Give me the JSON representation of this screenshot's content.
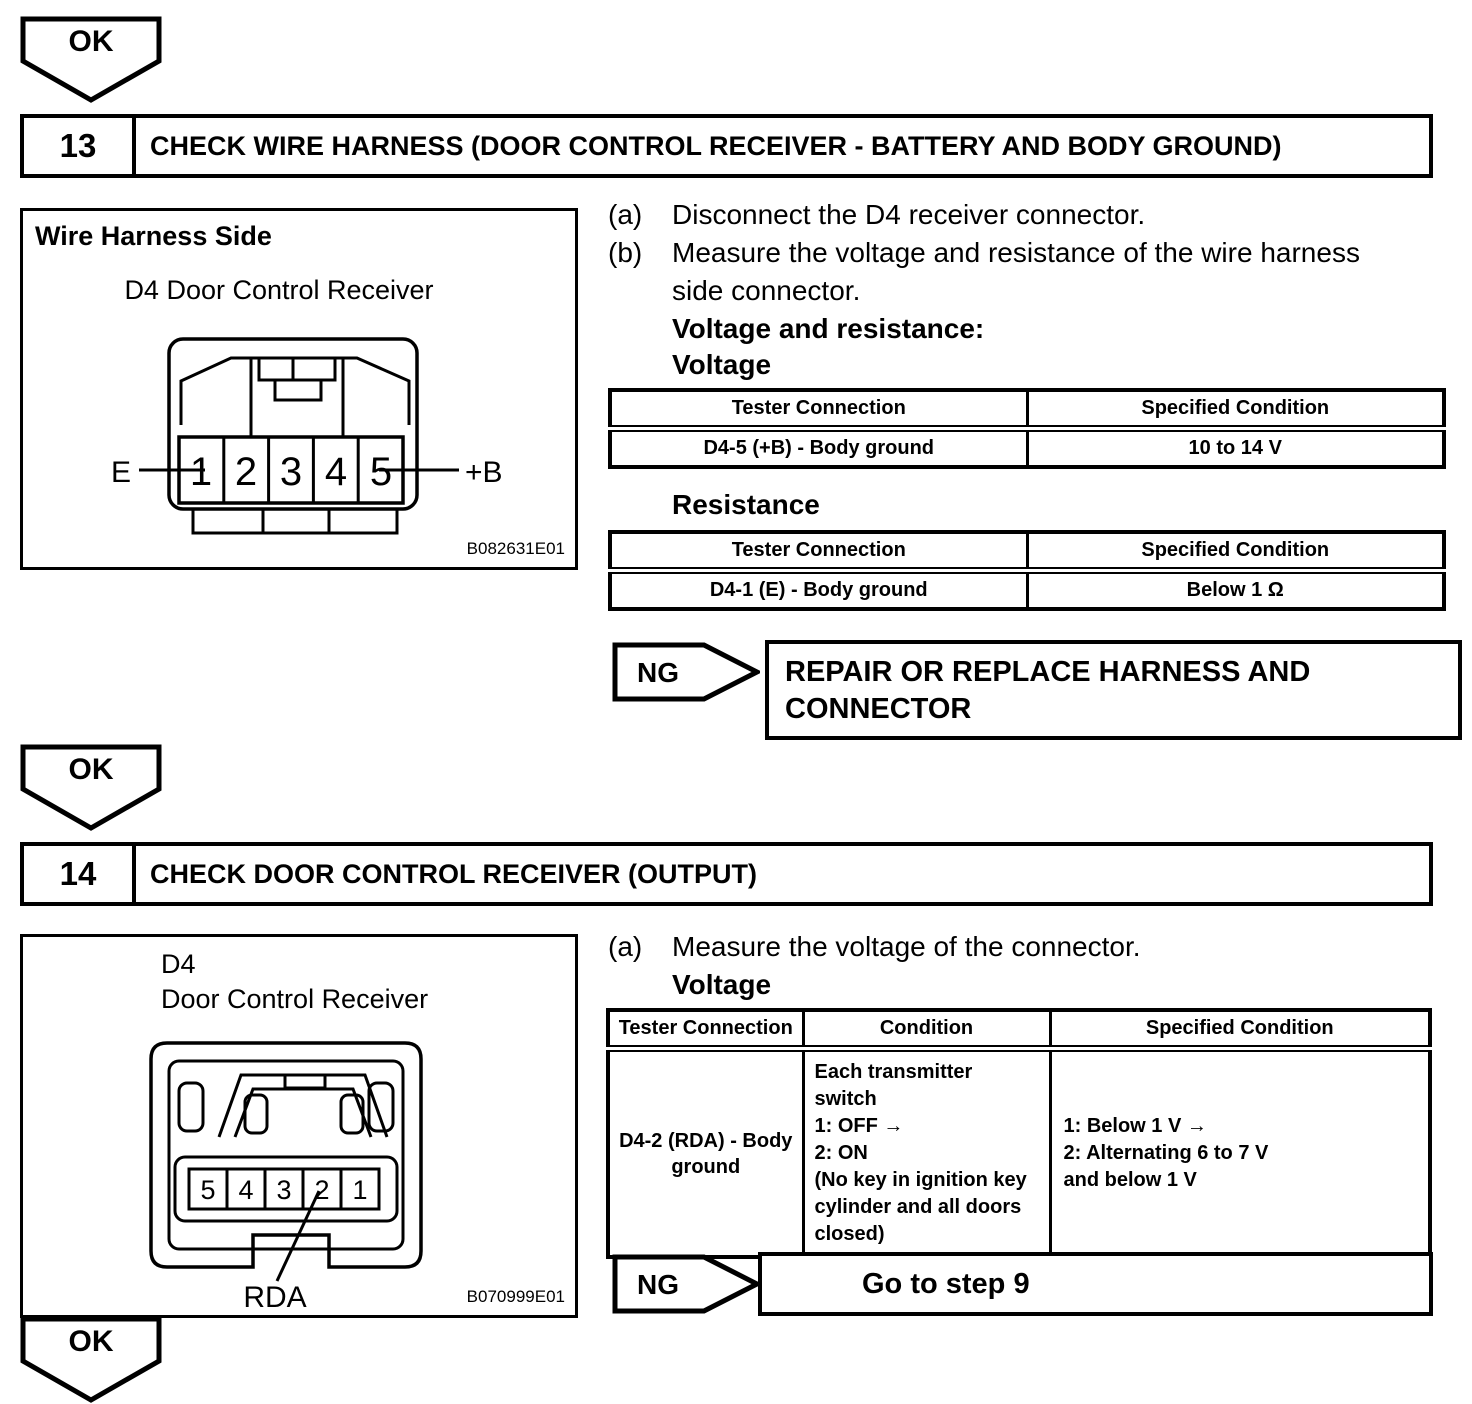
{
  "page": {
    "ok_label": "OK",
    "ng_label": "NG"
  },
  "step13": {
    "number": "13",
    "title": "CHECK WIRE HARNESS (DOOR CONTROL RECEIVER - BATTERY AND BODY GROUND)",
    "diagram": {
      "title": "Wire Harness Side",
      "subtitle": "D4 Door Control Receiver",
      "pins": [
        "1",
        "2",
        "3",
        "4",
        "5"
      ],
      "left_pin_label": "E",
      "right_pin_label": "+B",
      "code": "B082631E01"
    },
    "instructions": [
      {
        "index": "(a)",
        "text": "Disconnect the D4 receiver connector."
      },
      {
        "index": "(b)",
        "text": "Measure the voltage and resistance of the wire harness side connector."
      }
    ],
    "spec_label": "Voltage and resistance:",
    "voltage_heading": "Voltage",
    "voltage_table": {
      "headers": [
        "Tester Connection",
        "Specified Condition"
      ],
      "rows": [
        [
          "D4-5 (+B) - Body ground",
          "10 to 14 V"
        ]
      ]
    },
    "resistance_heading": "Resistance",
    "resistance_table": {
      "headers": [
        "Tester Connection",
        "Specified Condition"
      ],
      "rows": [
        [
          "D4-1 (E) - Body ground",
          "Below 1 Ω"
        ]
      ]
    },
    "ng_action": "REPAIR OR REPLACE HARNESS AND CONNECTOR"
  },
  "step14": {
    "number": "14",
    "title": "CHECK DOOR CONTROL RECEIVER (OUTPUT)",
    "diagram": {
      "title_line1": "D4",
      "title_line2": "Door Control Receiver",
      "pins": [
        "5",
        "4",
        "3",
        "2",
        "1"
      ],
      "pin_label": "RDA",
      "code": "B070999E01"
    },
    "instructions": [
      {
        "index": "(a)",
        "text": "Measure the voltage of the connector."
      }
    ],
    "voltage_heading": "Voltage",
    "voltage_table": {
      "headers": [
        "Tester Connection",
        "Condition",
        "Specified Condition"
      ],
      "rows": [
        {
          "tester": "D4-2 (RDA) - Body ground",
          "condition_lines": [
            "Each transmitter switch",
            "1: OFF →",
            "2: ON",
            "(No key in ignition key cylinder and all doors closed)"
          ],
          "specified_lines": [
            "1: Below 1 V →",
            "2: Alternating 6 to 7 V and below 1 V"
          ]
        }
      ]
    },
    "ng_action": "Go to step 9"
  }
}
